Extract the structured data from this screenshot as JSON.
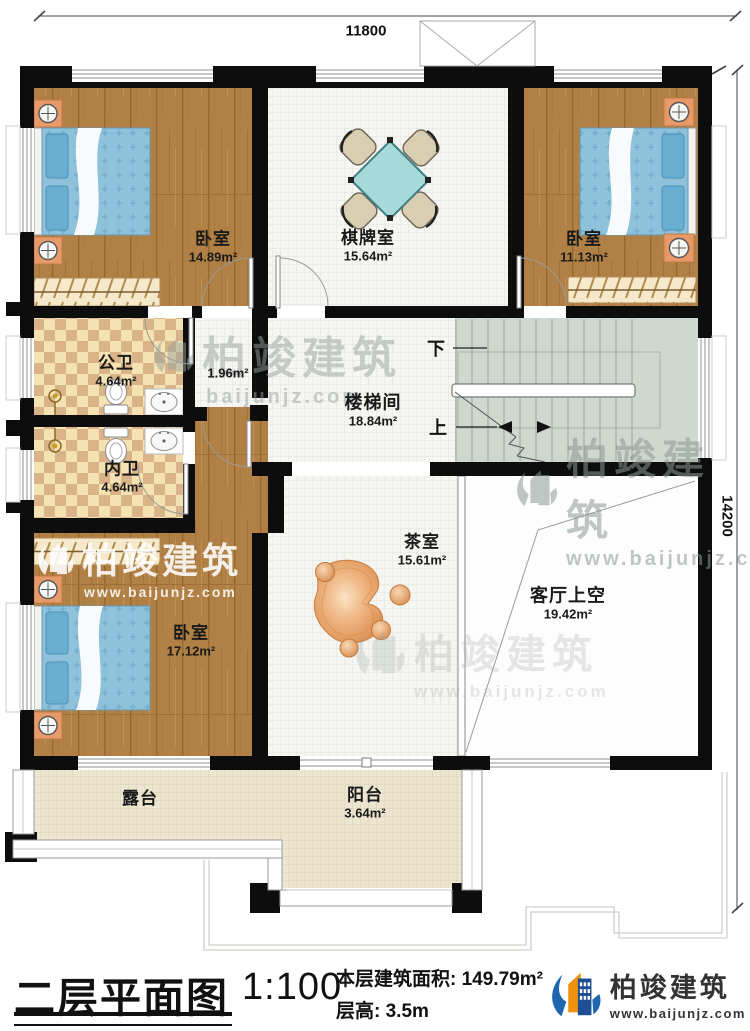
{
  "dimensions": {
    "top": "11800",
    "right": "14200"
  },
  "rooms": {
    "bedroom_top_left": {
      "name": "卧室",
      "area": "14.89m²"
    },
    "game_room": {
      "name": "棋牌室",
      "area": "15.64m²"
    },
    "bedroom_top_right": {
      "name": "卧室",
      "area": "11.13m²"
    },
    "public_bathroom": {
      "name": "公卫",
      "area": "4.64m²"
    },
    "hallway": {
      "area": "1.96m²"
    },
    "private_bathroom": {
      "name": "内卫",
      "area": "4.64m²"
    },
    "stairwell": {
      "name": "楼梯间",
      "area": "18.84m²"
    },
    "tea_room": {
      "name": "茶室",
      "area": "15.61m²"
    },
    "bedroom_bottom_left": {
      "name": "卧室",
      "area": "17.12m²"
    },
    "living_room_void": {
      "name": "客厅上空",
      "area": "19.42m²"
    },
    "terrace": {
      "name": "露台"
    },
    "balcony": {
      "name": "阳台",
      "area": "3.64m²"
    }
  },
  "stairs": {
    "down": "下",
    "up": "上"
  },
  "title_block": {
    "plan_title": "二层平面图",
    "scale": "1:100",
    "floor_area_label": "本层建筑面积:",
    "floor_area_value": "149.79m²",
    "floor_height_label": "层高:",
    "floor_height_value": "3.5m"
  },
  "brand": {
    "name": "柏竣建筑",
    "website": "www.baijunjz.com"
  },
  "watermarks": {
    "company": "柏竣建筑",
    "website": "www.baijunjz.com",
    "website_short": "baijunjz.com"
  }
}
